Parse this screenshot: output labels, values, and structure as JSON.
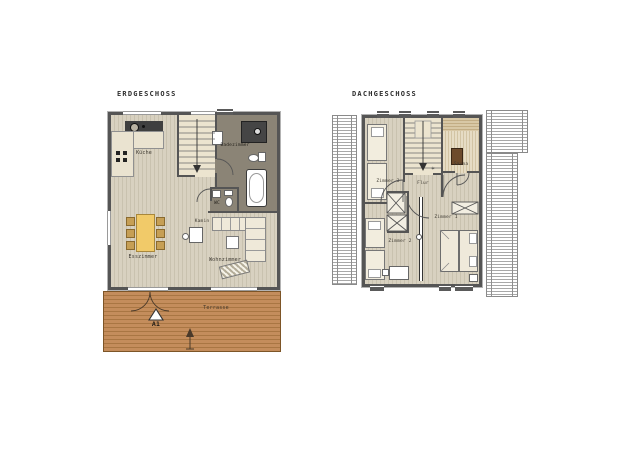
{
  "canvas": {
    "background": "#ffffff"
  },
  "eg": {
    "title": "ERDGESCHOSS",
    "rooms": {
      "kueche": "Küche",
      "badezimmer": "Badezimmer",
      "wc": "WC",
      "kamin": "Kamin",
      "esszimmer": "Esszimmer",
      "wohnzimmer": "Wohnzimmer",
      "terrasse": "Terrasse"
    },
    "marker": "A1"
  },
  "dg": {
    "title": "DACHGESCHOSS",
    "rooms": {
      "zimmer1": "Zimmer 1",
      "zimmer2": "Zimmer 2",
      "zimmer3": "Zimmer 3",
      "flur": "Flur",
      "sauna": "Sauna"
    }
  },
  "icons": {
    "stair_landing_star": "✶"
  },
  "colors": {
    "wall": "#555555",
    "wood_floor": "#d8d1c0",
    "bath_floor": "#8b8476",
    "terrace": "#c48d5c",
    "dining_table": "#f1ca69",
    "stair_floor": "#ece4cf",
    "sauna_stove": "#6d4b2c",
    "roof_hatch": "#a8a8a8"
  }
}
